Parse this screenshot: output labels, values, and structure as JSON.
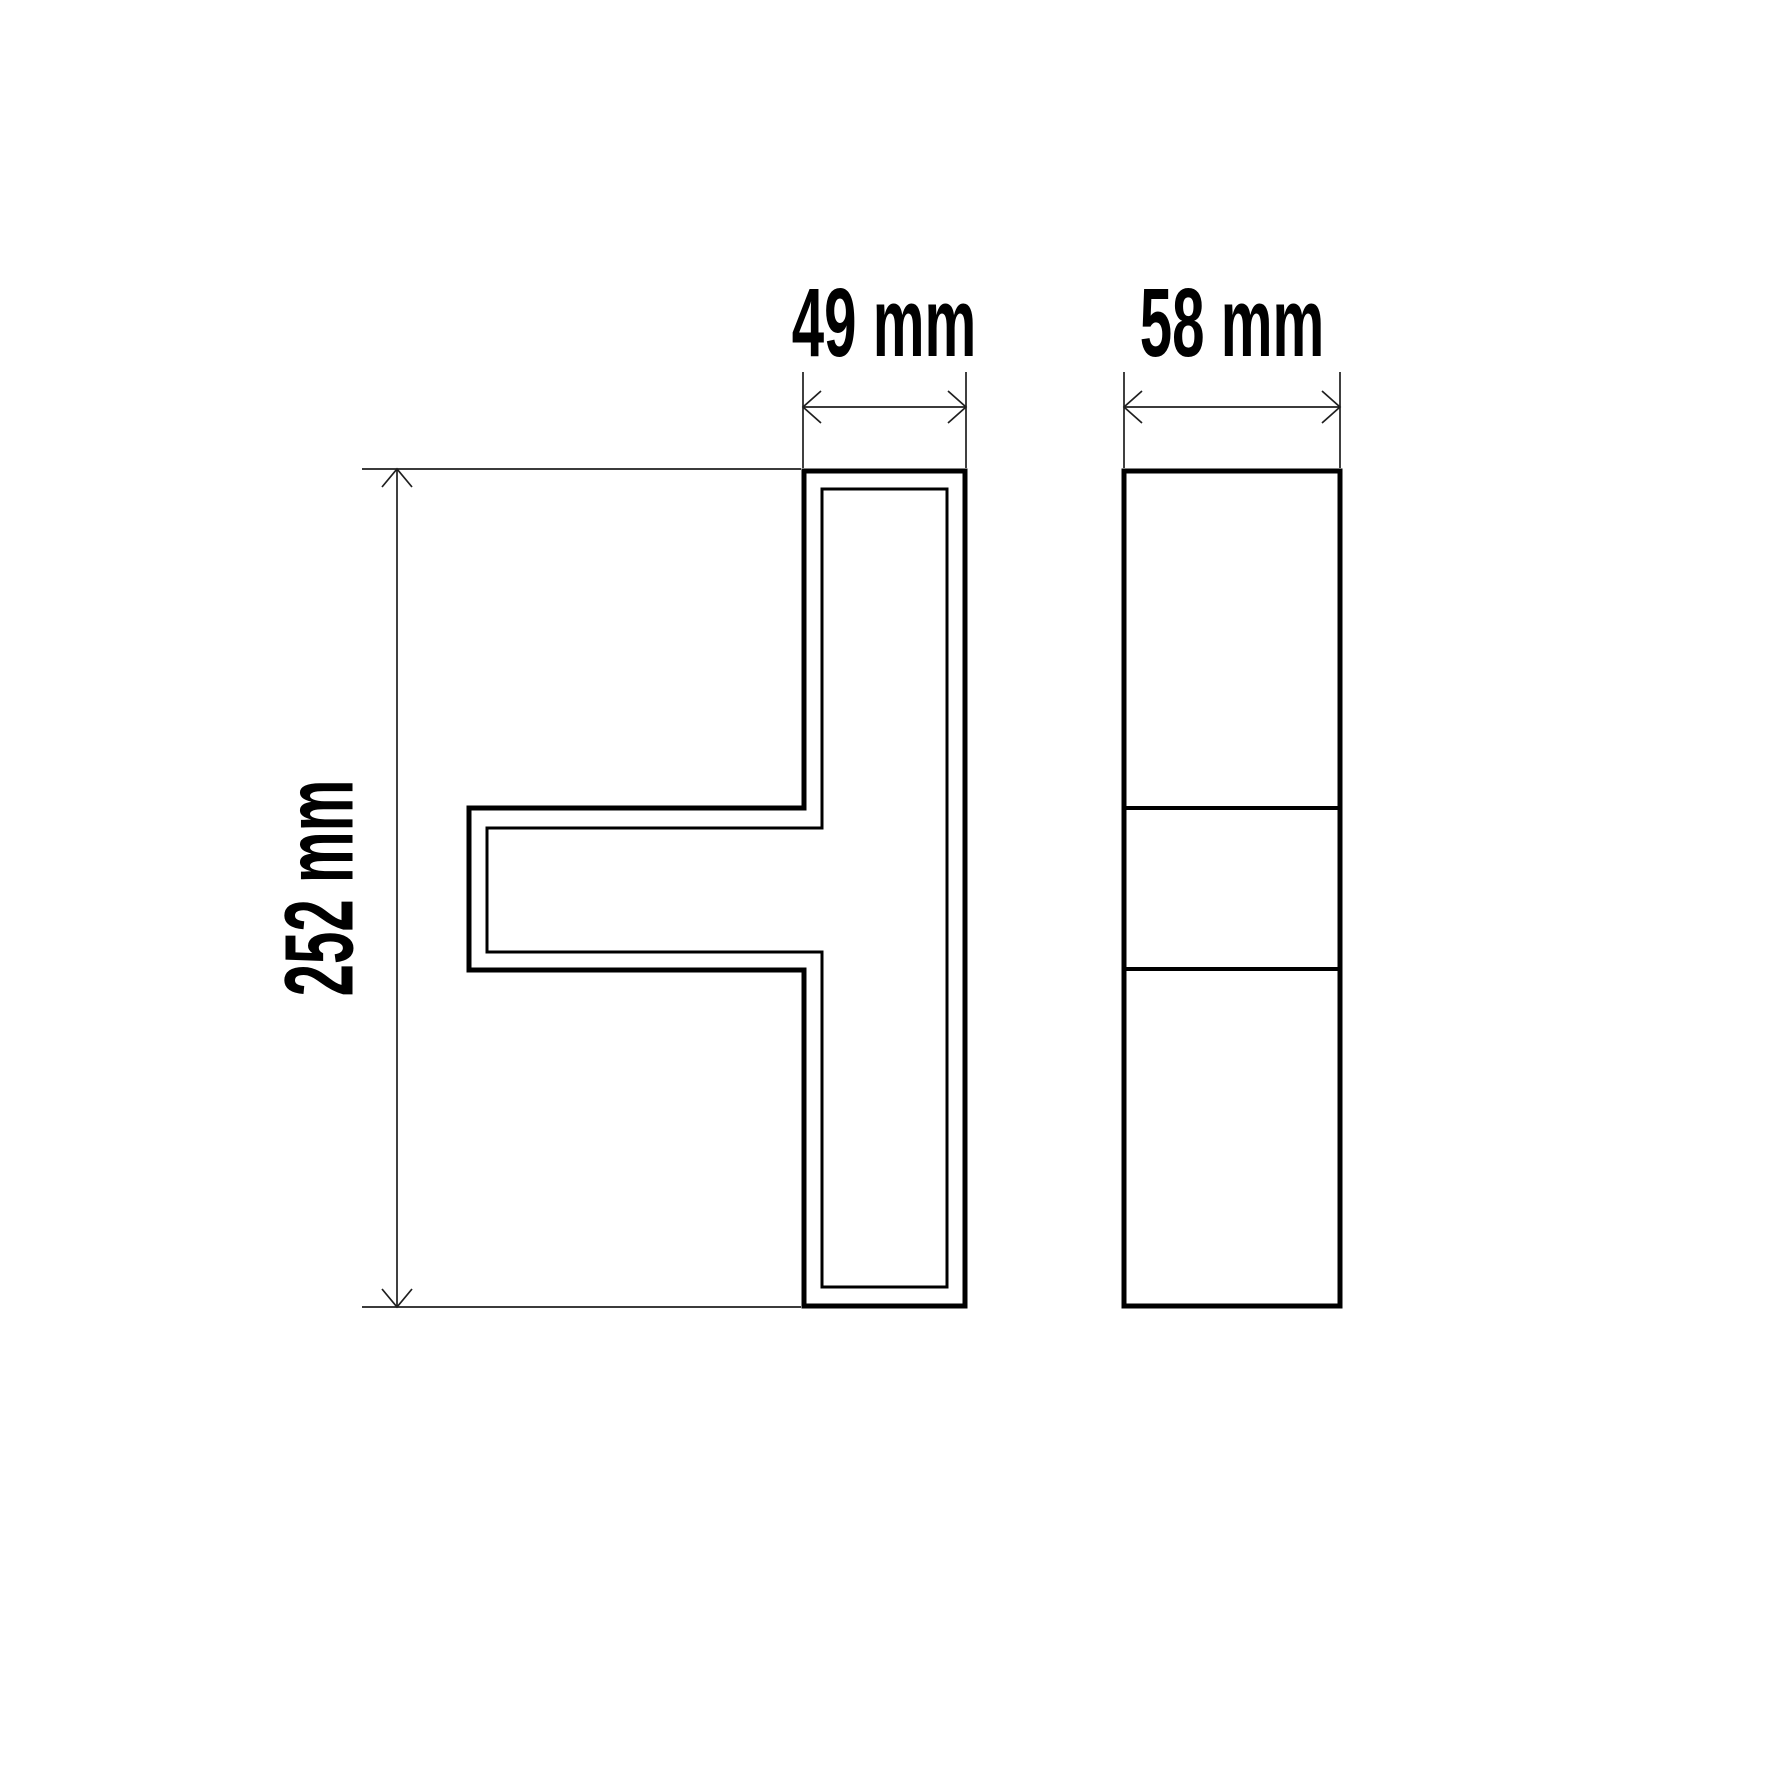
{
  "page": {
    "background_color": "#ffffff",
    "outline_color": "#000000",
    "dimension_line_color": "#1f1f1f"
  },
  "drawing": {
    "kind": "technical-dimension-drawing",
    "views": {
      "front": {
        "shape": "T-profile with inner contour"
      },
      "side": {
        "shape": "rectangle with 3 sections"
      }
    },
    "dimensions": {
      "width": {
        "label": "49 mm",
        "value_mm": 49
      },
      "depth": {
        "label": "58 mm",
        "value_mm": 58
      },
      "height": {
        "label": "252 mm",
        "value_mm": 252
      }
    }
  }
}
